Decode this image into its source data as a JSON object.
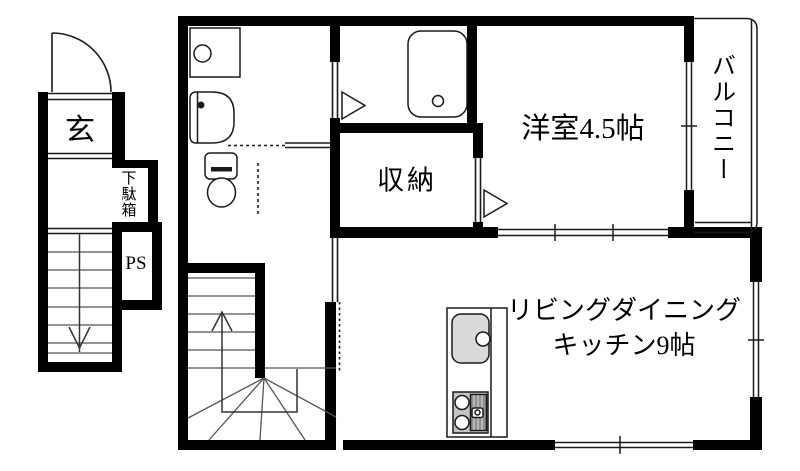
{
  "floorplan": {
    "labels": {
      "entrance": "玄",
      "shoe_cabinet": "下駄箱",
      "pipe_space": "PS",
      "storage": "収納",
      "western_room": "洋室4.5帖",
      "balcony": "バルコニー",
      "ldk_line1": "リビングダイニング",
      "ldk_line2": "キッチン9帖"
    },
    "colors": {
      "wall": "#000000",
      "background": "#ffffff",
      "fixture_line": "#1a1a1a",
      "tread_line": "#555555",
      "sink_fill": "#d9d9d9",
      "stove_fill": "#c4c4c4",
      "grill_fill": "#8f8f8f"
    }
  }
}
